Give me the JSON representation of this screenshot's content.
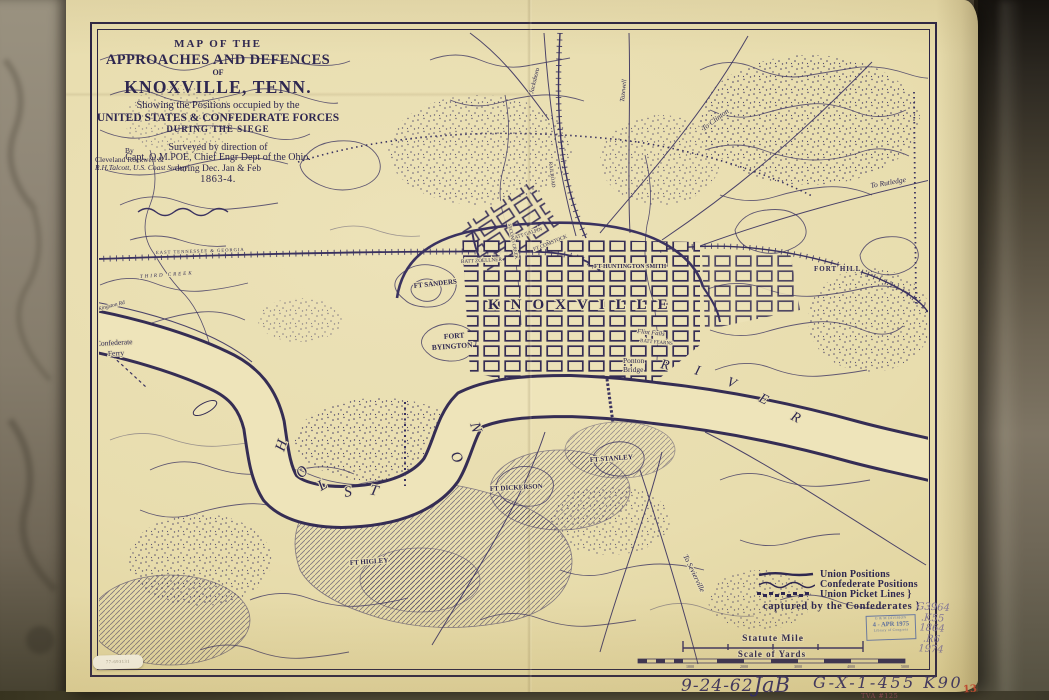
{
  "title_block": {
    "t1": "MAP OF THE",
    "t2": "APPROACHES AND DEFENCES",
    "t3": "OF",
    "t4": "KNOXVILLE, TENN.",
    "t5": "Showing the Positions occupied by the",
    "t6": "UNITED STATES & CONFEDERATE FORCES",
    "t7": "DURING THE SIEGE",
    "t8": "Surveyed by direction of",
    "t9": "Capt. O.M.POE, Chief Engr Dept of the Ohio.",
    "t10": "during Dec. Jan & Feb",
    "t11": "1863-4.",
    "by1": "By",
    "by2": "Cleveland Rockwell &",
    "by3": "R.H.Talcott, U.S. Coast Survey"
  },
  "map_labels": {
    "knoxville": "KNOXVILLE",
    "holston": [
      "H",
      "O",
      "L",
      "S",
      "T",
      "O",
      "N"
    ],
    "river": [
      "R",
      "I",
      "V",
      "E",
      "R"
    ],
    "ponton1": "Ponton",
    "ponton2": "Bridge",
    "ferry1": "Confederate",
    "ferry2": "Ferry",
    "ft_sanders": "FT SANDERS",
    "fort_w1": "FORT",
    "fort_w2": "BYINGTON",
    "fort_hill": "FORT HILL",
    "ft_huntington": "FT HUNTINGTON SMITH",
    "batt_zoellner": "BATT ZOELLNER",
    "ft_comstock": "FT COMSTOCK",
    "batt_galpin": "BATT GALPIN",
    "ft_dickerson": "FT DICKERSON",
    "ft_stanley": "FT STANLEY",
    "ft_higley": "FT HIGLEY",
    "flint_falls": "Flint Falls",
    "batt_fearns": "BATT FEARNS",
    "third_creek": "THIRD CREEK",
    "second_creek": "SECOND CREEK",
    "etg_rr": "EAST TENNESSEE & GEORGIA",
    "railroad": "RAILROAD",
    "to_clinton": "To Clinton",
    "to_rutledge": "To Rutledge",
    "jacksboro": "Jacksboro",
    "tazewell": "Tazewell",
    "to_sevierville": "To Sevierville",
    "to_kingston": "To Kingston Rd"
  },
  "legend": {
    "union": "Union Positions",
    "confederate": "Confederate Positions",
    "picket": "Union Picket Lines }",
    "captured": "captured by the Confederates }"
  },
  "scale": {
    "statute_mile": "Statute Mile",
    "scale_of_yards": "Scale of Yards",
    "yard_ticks": [
      "1000",
      "2000",
      "3000",
      "4000",
      "5000"
    ]
  },
  "stamp": {
    "line1": "G & M DIVISION",
    "line2": "4 - APR 1975",
    "line3": "Library of Congress"
  },
  "call_number": [
    "G3964",
    ".K55",
    "1864",
    ".R6",
    "1974"
  ],
  "annotations": {
    "date": "9-24-62",
    "initials": "JaB",
    "code": "G-X-1-455 K90",
    "tva": "TVA #125",
    "page_number": "13",
    "sticker": "77-693131"
  }
}
